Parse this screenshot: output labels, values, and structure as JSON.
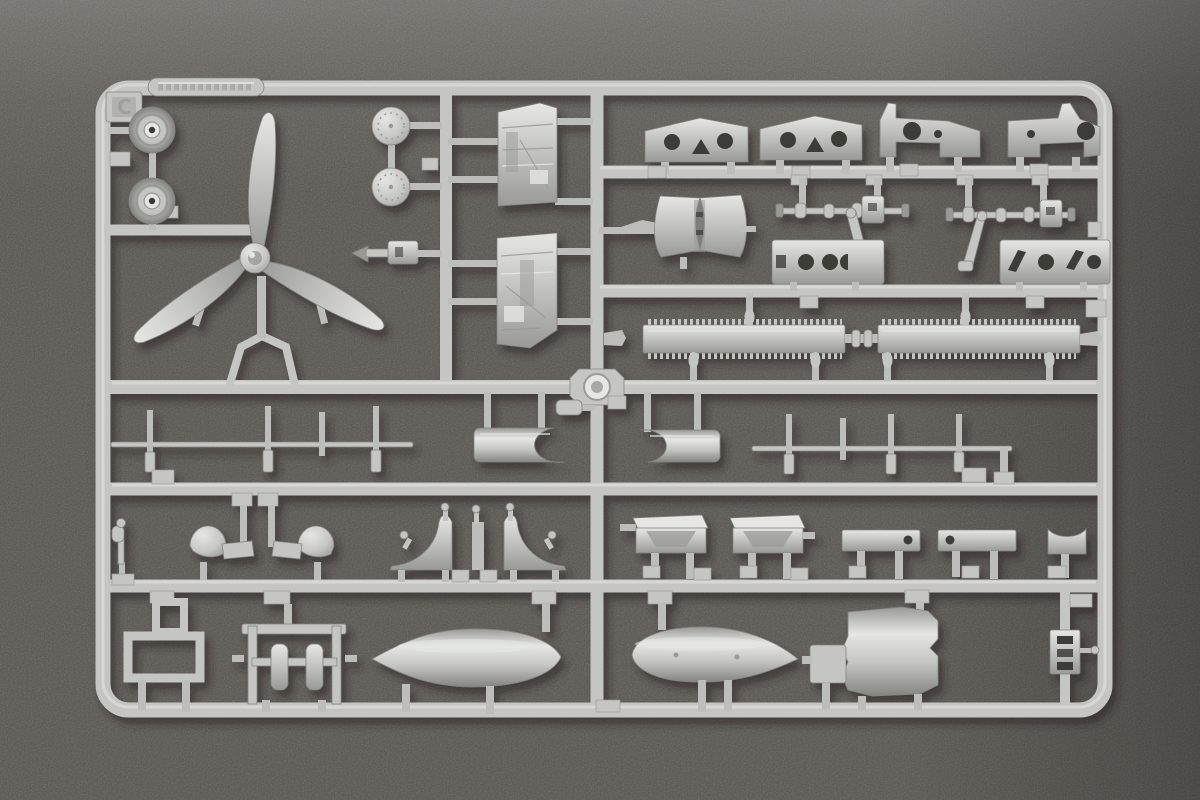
{
  "scene": {
    "description": "Photograph of a gray injection-molded plastic model kit sprue (parts frame) lying on dark textured felt",
    "sprue_letter": "C",
    "embossed_label": "raised molded brand plate, text illegible",
    "colors": {
      "background": "#57544e",
      "background_top": "#6e6c66",
      "background_deep": "#454239",
      "plastic": "#c5c6c2",
      "plastic_highlight": "#e6e7e3",
      "plastic_shadow": "#999a95",
      "plastic_deep": "#84857f",
      "plastic_gate": "#bdbeba",
      "outline": "#83847e",
      "hole": "#3e3c37",
      "cast_shadow": "#26241f"
    },
    "parts": [
      {
        "id": "main-wheel",
        "label": "main wheel",
        "count": 2
      },
      {
        "id": "propeller",
        "label": "three-blade propeller",
        "count": 1
      },
      {
        "id": "hub-disc",
        "label": "round hub disc",
        "count": 2
      },
      {
        "id": "small-strut",
        "label": "small strut fitting",
        "count": 1
      },
      {
        "id": "cockpit-sidewall",
        "label": "cockpit sidewall panel",
        "count": 2
      },
      {
        "id": "perforated-bracket",
        "label": "perforated mounting bracket",
        "count": 4
      },
      {
        "id": "seat-back",
        "label": "curved seat back plate",
        "count": 1
      },
      {
        "id": "linked-shaft",
        "label": "shaft with couplings and link rod",
        "count": 2
      },
      {
        "id": "perforated-plate",
        "label": "flat plate with lightening holes",
        "count": 2
      },
      {
        "id": "serrated-strip",
        "label": "long serrated radiator strip",
        "count": 2
      },
      {
        "id": "pin-rod",
        "label": "long rod with cast-on pins",
        "count": 2
      },
      {
        "id": "cowl-section",
        "label": "curved cowl section",
        "count": 2
      },
      {
        "id": "control-stick",
        "label": "control stick",
        "count": 1
      },
      {
        "id": "dome-blister",
        "label": "dome blister with tab",
        "count": 2
      },
      {
        "id": "hinge-bracket",
        "label": "curved hinge bracket",
        "count": 2
      },
      {
        "id": "intake-box",
        "label": "intake box",
        "count": 2
      },
      {
        "id": "hole-bar",
        "label": "flat bar with hole",
        "count": 2
      },
      {
        "id": "saddle-clamp",
        "label": "saddle clamp",
        "count": 1
      },
      {
        "id": "step-frame",
        "label": "open rectangular frame",
        "count": 1
      },
      {
        "id": "bomb-rack",
        "label": "bomb rack cradle",
        "count": 1
      },
      {
        "id": "drop-tank",
        "label": "teardrop drop tank",
        "count": 2
      },
      {
        "id": "bulkhead-plate",
        "label": "flat armored bulkhead plate",
        "count": 1
      },
      {
        "id": "slotted-bracket",
        "label": "small bracket with three slots",
        "count": 1
      }
    ]
  }
}
